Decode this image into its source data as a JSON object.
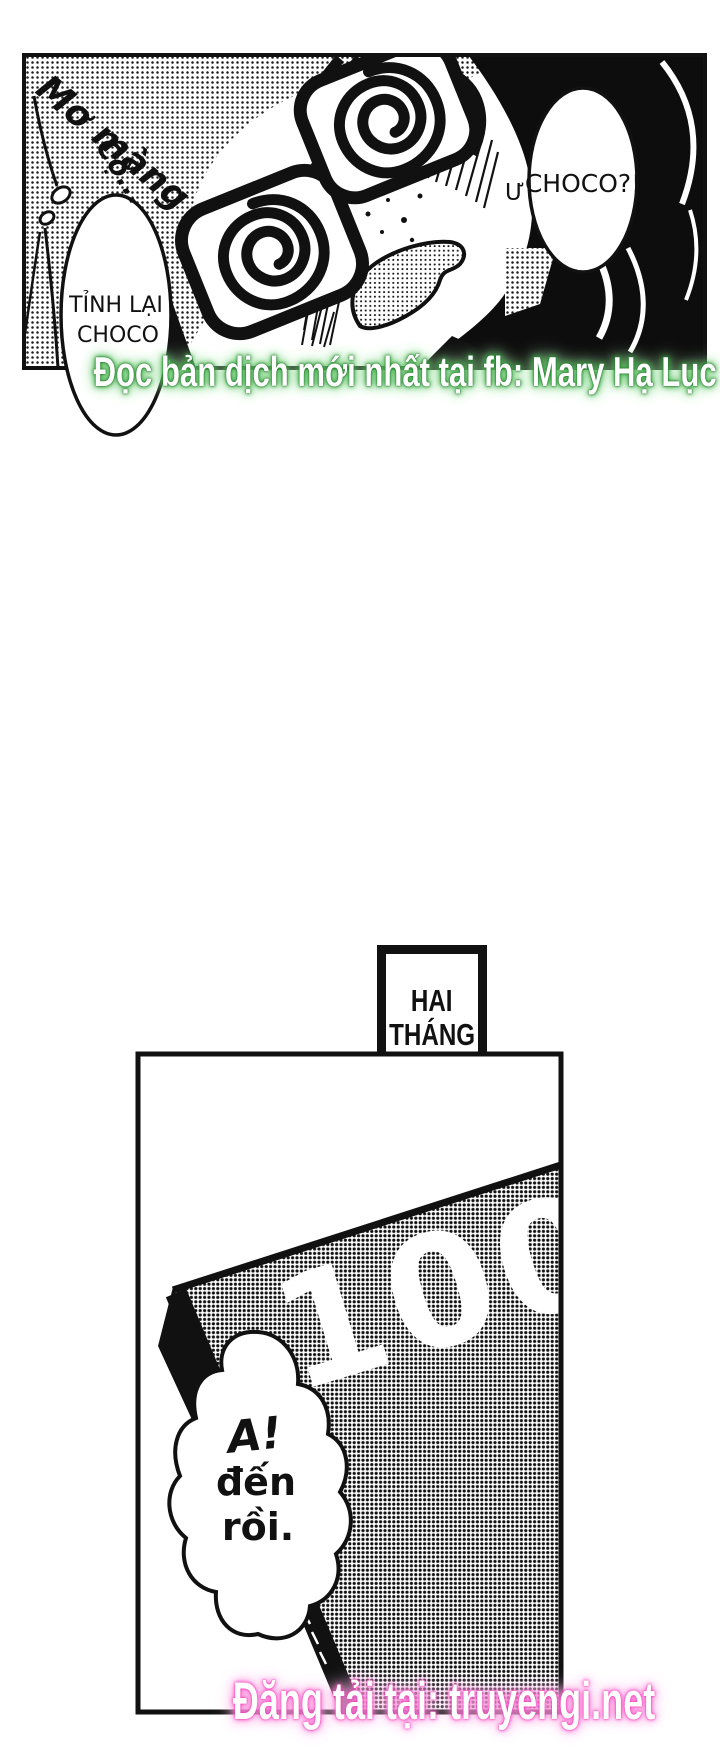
{
  "panel1": {
    "sfx_dreamy": "Mơ màng",
    "sfx_mumble": "Cộ...",
    "left_bubble": [
      "TỈNH LẠI",
      "CHOCO"
    ],
    "right_bubble_prefix": "Ư",
    "right_bubble_text": "CHOCO?!"
  },
  "green_watermark": {
    "text": "Đọc bản dịch mới nhất tại fb: Mary Hạ Lục",
    "glow_color": "#2e9e38"
  },
  "timeskip_box": {
    "line1": "HAI",
    "line2": "THÁNG",
    "line3": "SAU"
  },
  "panel2": {
    "package_label": "100",
    "bubble_line1": "A!",
    "bubble_line2": "đến",
    "bubble_line3": "rồi."
  },
  "pink_watermark": {
    "text": "Đăng tải tại: truyengi.net",
    "glow_color": "#f646c1"
  },
  "colors": {
    "ink": "#111111",
    "paper": "#ffffff"
  }
}
